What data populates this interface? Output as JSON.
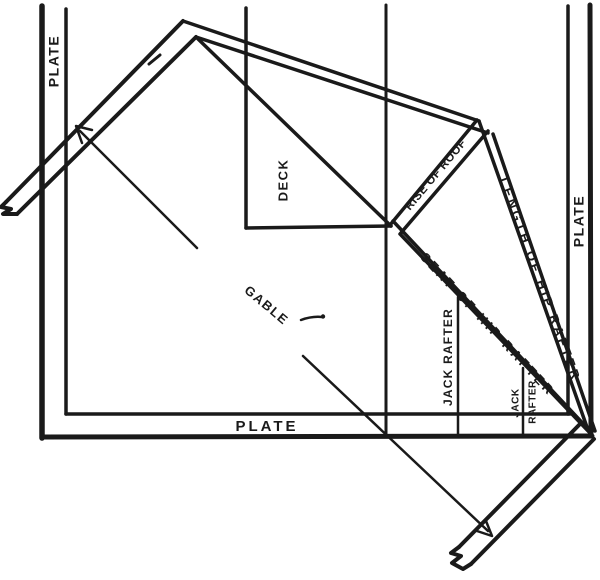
{
  "figure": {
    "colors": {
      "ink": "#1a1a1a",
      "background": "#ffffff"
    },
    "labels": {
      "plate_left": "PLATE",
      "plate_bottom": "PLATE",
      "plate_right": "PLATE",
      "deck": "DECK",
      "gable": "GABLE",
      "rise_of_roof": "RISE OF ROOF",
      "length_of_hip_rafter": "LENGTH OF HIP RAFTER",
      "seat_of_hip_rafter": "SEAT OF HIP RAFTER",
      "jack_rafter": "JACK RAFTER",
      "jack_small": "JACK",
      "rafter_small": "RAFTER"
    }
  }
}
